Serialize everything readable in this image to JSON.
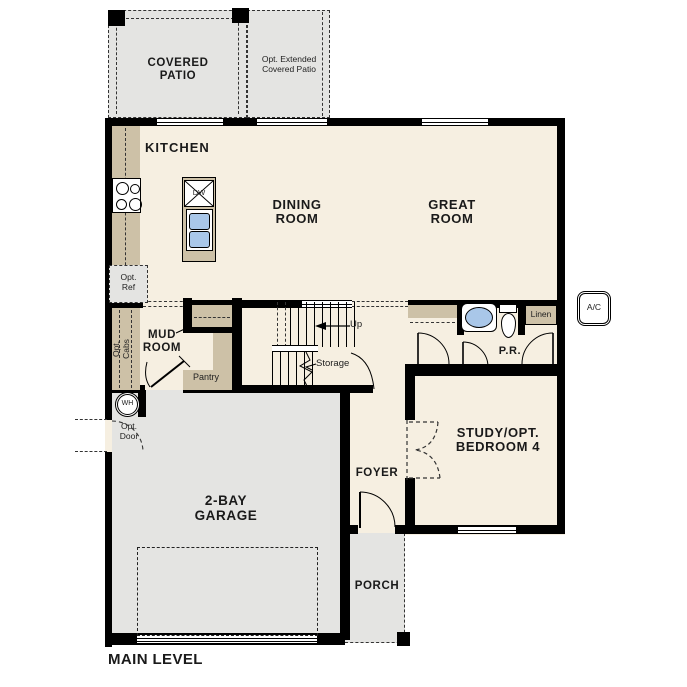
{
  "title": "MAIN LEVEL",
  "colors": {
    "floor": "#f6efe1",
    "outdoor_concrete": "#e4e4e2",
    "cabinetry_tan": "#cdc1a7",
    "wall": "#000000",
    "fixture_blue": "#a9c7e9"
  },
  "rooms": {
    "covered_patio": "COVERED\nPATIO",
    "opt_extended_patio": "Opt. Extended\nCovered Patio",
    "kitchen": "KITCHEN",
    "dining_room": "DINING\nROOM",
    "great_room": "GREAT\nROOM",
    "mud_room": "MUD\nROOM",
    "powder_room": "P.R.",
    "study": "STUDY/OPT.\nBEDROOM 4",
    "foyer": "FOYER",
    "porch": "PORCH",
    "garage": "2-BAY\nGARAGE"
  },
  "features": {
    "pantry": "Pantry",
    "linen": "Linen",
    "storage": "Storage",
    "up": "Up",
    "opt_ref": "Opt.\nRef",
    "opt_cabs": "Opt.\nCabs",
    "opt_door": "Opt.\nDoor",
    "water_heater": "WH",
    "ac_unit": "A/C",
    "dishwasher": "DW"
  }
}
